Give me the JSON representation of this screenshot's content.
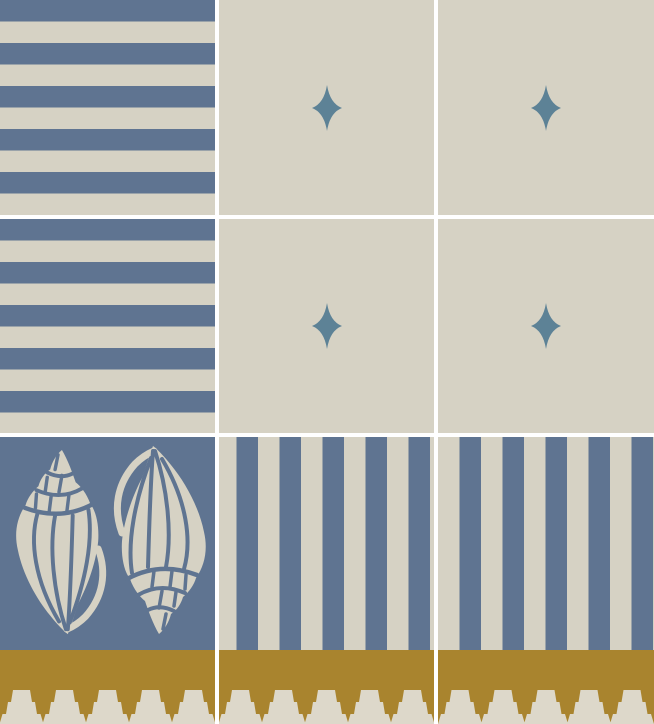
{
  "colors": {
    "blue": "#5F7491",
    "cream": "#D6D2C4",
    "teal": "#5D8296",
    "gold": "#A9842E",
    "cream-light": "#DDD8CA",
    "gap": "#FFFFFF"
  },
  "pattern": {
    "grid": {
      "columns": 3,
      "pattern_rows": 3,
      "column_gap_px": 4,
      "row_gap_px": 4,
      "tile_size_px": 215
    },
    "stripe_period_px": 43,
    "tiles": [
      [
        "horizontal-stripes",
        "sparkle-star",
        "sparkle-star"
      ],
      [
        "horizontal-stripes",
        "sparkle-star",
        "sparkle-star"
      ],
      [
        "seashells",
        "vertical-stripes",
        "vertical-stripes"
      ]
    ],
    "motifs": {
      "horizontal-stripes": {
        "description": "alternating blue and cream horizontal stripes, blue first",
        "stripes_per_tile": 10
      },
      "vertical-stripes": {
        "description": "alternating cream and blue vertical stripes",
        "stripes_per_tile": 10
      },
      "sparkle-star": {
        "description": "four-point teal sparkle star centered on cream tile",
        "star_width_px": 30,
        "star_height_px": 46,
        "tile_count": 4
      },
      "seashells": {
        "description": "two cream whelk seashells stenciled on blue, right shell rotated 180 degrees",
        "shell_count": 2
      }
    },
    "border": {
      "motif": "stepped-crown-frieze",
      "segments": 3,
      "crowns_per_segment": 5,
      "height_px": 74,
      "tiers_per_crown": 3
    }
  }
}
